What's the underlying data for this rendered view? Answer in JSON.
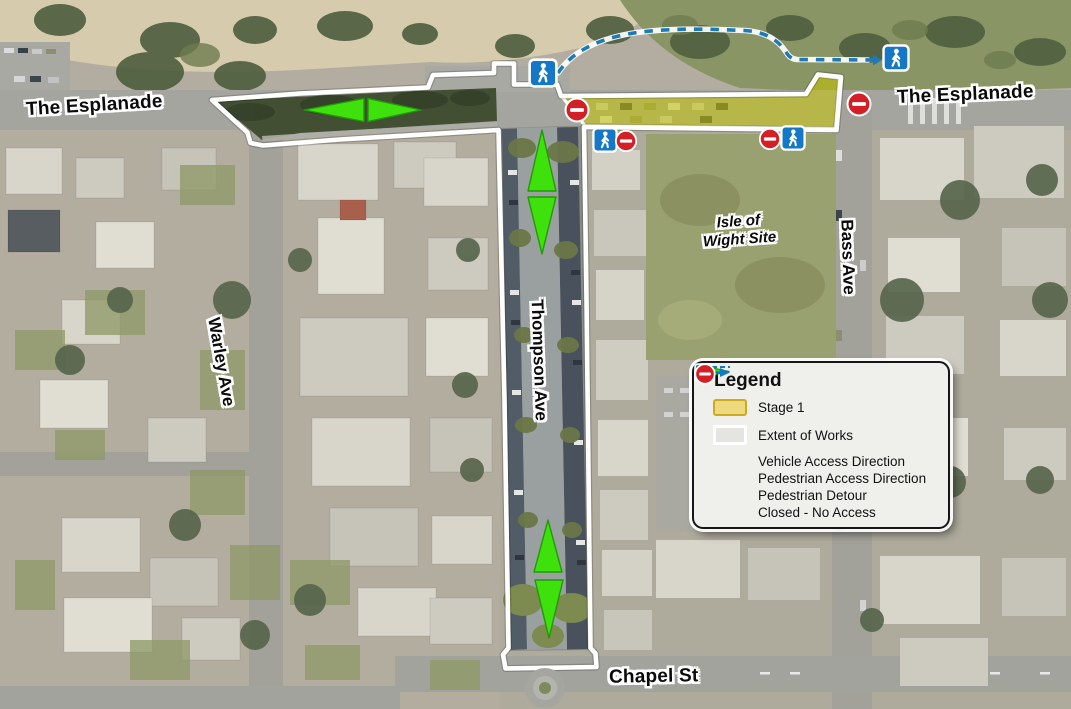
{
  "map": {
    "labels": {
      "esplanade_left": "The Esplanade",
      "esplanade_right": "The Esplanade",
      "warley": "Warley Ave",
      "thompson": "Thompson Ave",
      "bass": "Bass Ave",
      "isle_line1": "Isle of",
      "isle_line2": "Wight Site",
      "chapel": "Chapel St"
    },
    "icon_names": {
      "pedestrian": "pedestrian-icon",
      "no_entry": "no-entry-icon",
      "vehicle_arrow": "vehicle-arrow-icon",
      "detour": "pedestrian-detour-line"
    }
  },
  "legend": {
    "title": "Legend",
    "items": [
      {
        "icon": "stage1-swatch",
        "label": "Stage 1"
      },
      {
        "icon": "extent-swatch",
        "label": "Extent of Works"
      },
      {
        "icon": "vehicle-arrow",
        "label": "Vehicle Access Direction"
      },
      {
        "icon": "pedestrian-access",
        "label": "Pedestrian Access Direction"
      },
      {
        "icon": "detour-line",
        "label": "Pedestrian Detour"
      },
      {
        "icon": "closed-no-access",
        "label": "Closed - No Access"
      }
    ]
  },
  "colors": {
    "stage1_fill": "#eeda7e",
    "stage1_border": "#cfa91e",
    "stage1_map_overlay": "#c6c400",
    "works_white": "#ffffff",
    "vehicle_green": "#3fe10d",
    "vehicle_green_dark": "#219906",
    "pedestrian_blue": "#1577c8",
    "detour_blue": "#1d7ab8",
    "closed_red": "#d41f26",
    "label_black": "#0b0b0b"
  }
}
